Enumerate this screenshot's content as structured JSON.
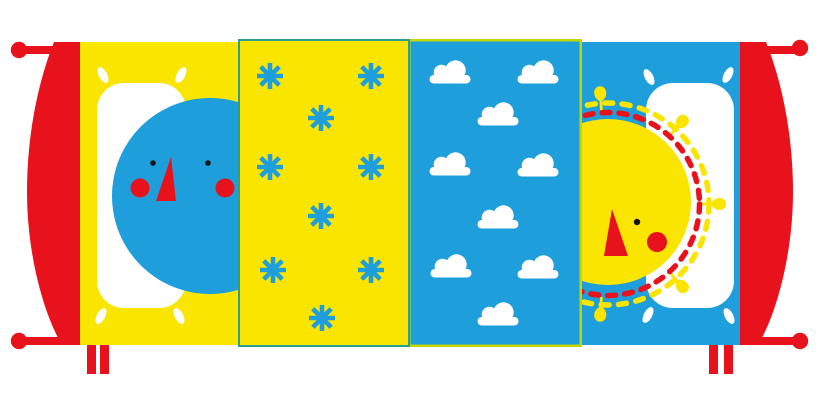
{
  "scene": {
    "description": "Flat illustration of a bed seen from above: red bed frame with round knobs and legs, a sleeping blue moon face on a white pillow over a yellow blanket, a yellow snowflake blanket, a blue cloud blanket, and a waking yellow sun face with dashed rays on a white pillow over a blue blanket",
    "background": "#FFFFFF",
    "width": 820,
    "height": 410
  },
  "colors": {
    "red": "#E8121D",
    "yellow": "#F9E500",
    "blue": "#1E9FDB",
    "teal_border": "#2E9E8E",
    "lime_border": "#C2D500",
    "white": "#FFFFFF",
    "black": "#141414"
  },
  "panels": {
    "moon_blanket": {
      "fill_key": "yellow",
      "motif": "none"
    },
    "snowflake_blanket": {
      "fill_key": "yellow",
      "border_key": "teal_border",
      "motif": "asterisk",
      "motif_color_key": "blue",
      "motif_count": 9
    },
    "cloud_blanket": {
      "fill_key": "blue",
      "border_key": "lime_border",
      "motif": "cloud",
      "motif_color_key": "white",
      "motif_count": 9
    },
    "sun_blanket": {
      "fill_key": "blue",
      "motif": "none"
    }
  },
  "patterns": {
    "asterisks": [
      [
        270,
        76
      ],
      [
        371,
        76
      ],
      [
        321,
        118
      ],
      [
        270,
        167
      ],
      [
        371,
        167
      ],
      [
        321,
        216
      ],
      [
        273,
        270
      ],
      [
        371,
        270
      ],
      [
        322,
        318
      ]
    ],
    "clouds": [
      [
        450,
        73
      ],
      [
        538,
        73
      ],
      [
        498,
        115
      ],
      [
        450,
        165
      ],
      [
        538,
        166
      ],
      [
        498,
        218
      ],
      [
        451,
        267
      ],
      [
        538,
        268
      ],
      [
        498,
        315
      ]
    ],
    "sun_ray_angles_deg": [
      94,
      48,
      0,
      -48,
      -94
    ]
  },
  "moon": {
    "center": [
      210,
      196
    ],
    "radius": 98,
    "eye_count": 2,
    "cheek_count": 2
  },
  "sun": {
    "center": [
      608,
      202
    ],
    "radius": 83,
    "red_dash_ring_radius": 91.5,
    "yellow_dash_ring_radius": 101,
    "eye_count": 1,
    "cheek_count": 1
  }
}
